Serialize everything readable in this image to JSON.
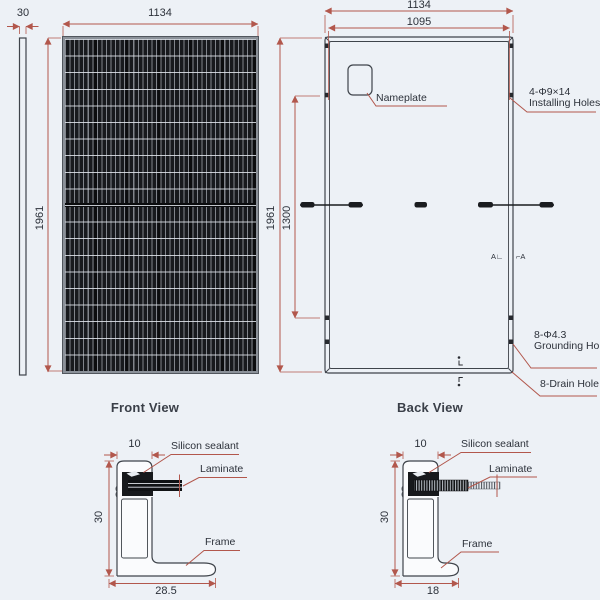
{
  "colors": {
    "background": "#edf1f6",
    "outline": "#3f444b",
    "dimension_red": "#b2574c",
    "panel_dark": "#17191d",
    "text": "#2c313a"
  },
  "side_view": {
    "thickness_dim": "30"
  },
  "front_view": {
    "width_dim": "1134",
    "height_dim": "1961",
    "caption": "Front View"
  },
  "back_view": {
    "outer_width_dim": "1134",
    "hole_span_dim": "1095",
    "height_dim": "1961",
    "hole_pitch_dim": "1300",
    "caption": "Back View",
    "nameplate_label": "Nameplate",
    "installing_holes_line1": "4-Φ9×14",
    "installing_holes_line2": "Installing Holes",
    "grounding_holes_line1": "8-Φ4.3",
    "grounding_holes_line2": "Grounding Holes",
    "drain_hole_label": "8-Drain Hole",
    "section_marker_left": "A∟",
    "section_marker_right": "⌐A"
  },
  "sections": {
    "left": {
      "top_dim": "10",
      "height_dim": "30",
      "base_dim": "28.5",
      "sealant_label": "Silicon sealant",
      "laminate_label": "Laminate",
      "frame_label": "Frame"
    },
    "right": {
      "top_dim": "10",
      "height_dim": "30",
      "base_dim": "18",
      "sealant_label": "Silicon sealant",
      "laminate_label": "Laminate",
      "frame_label": "Frame"
    }
  }
}
